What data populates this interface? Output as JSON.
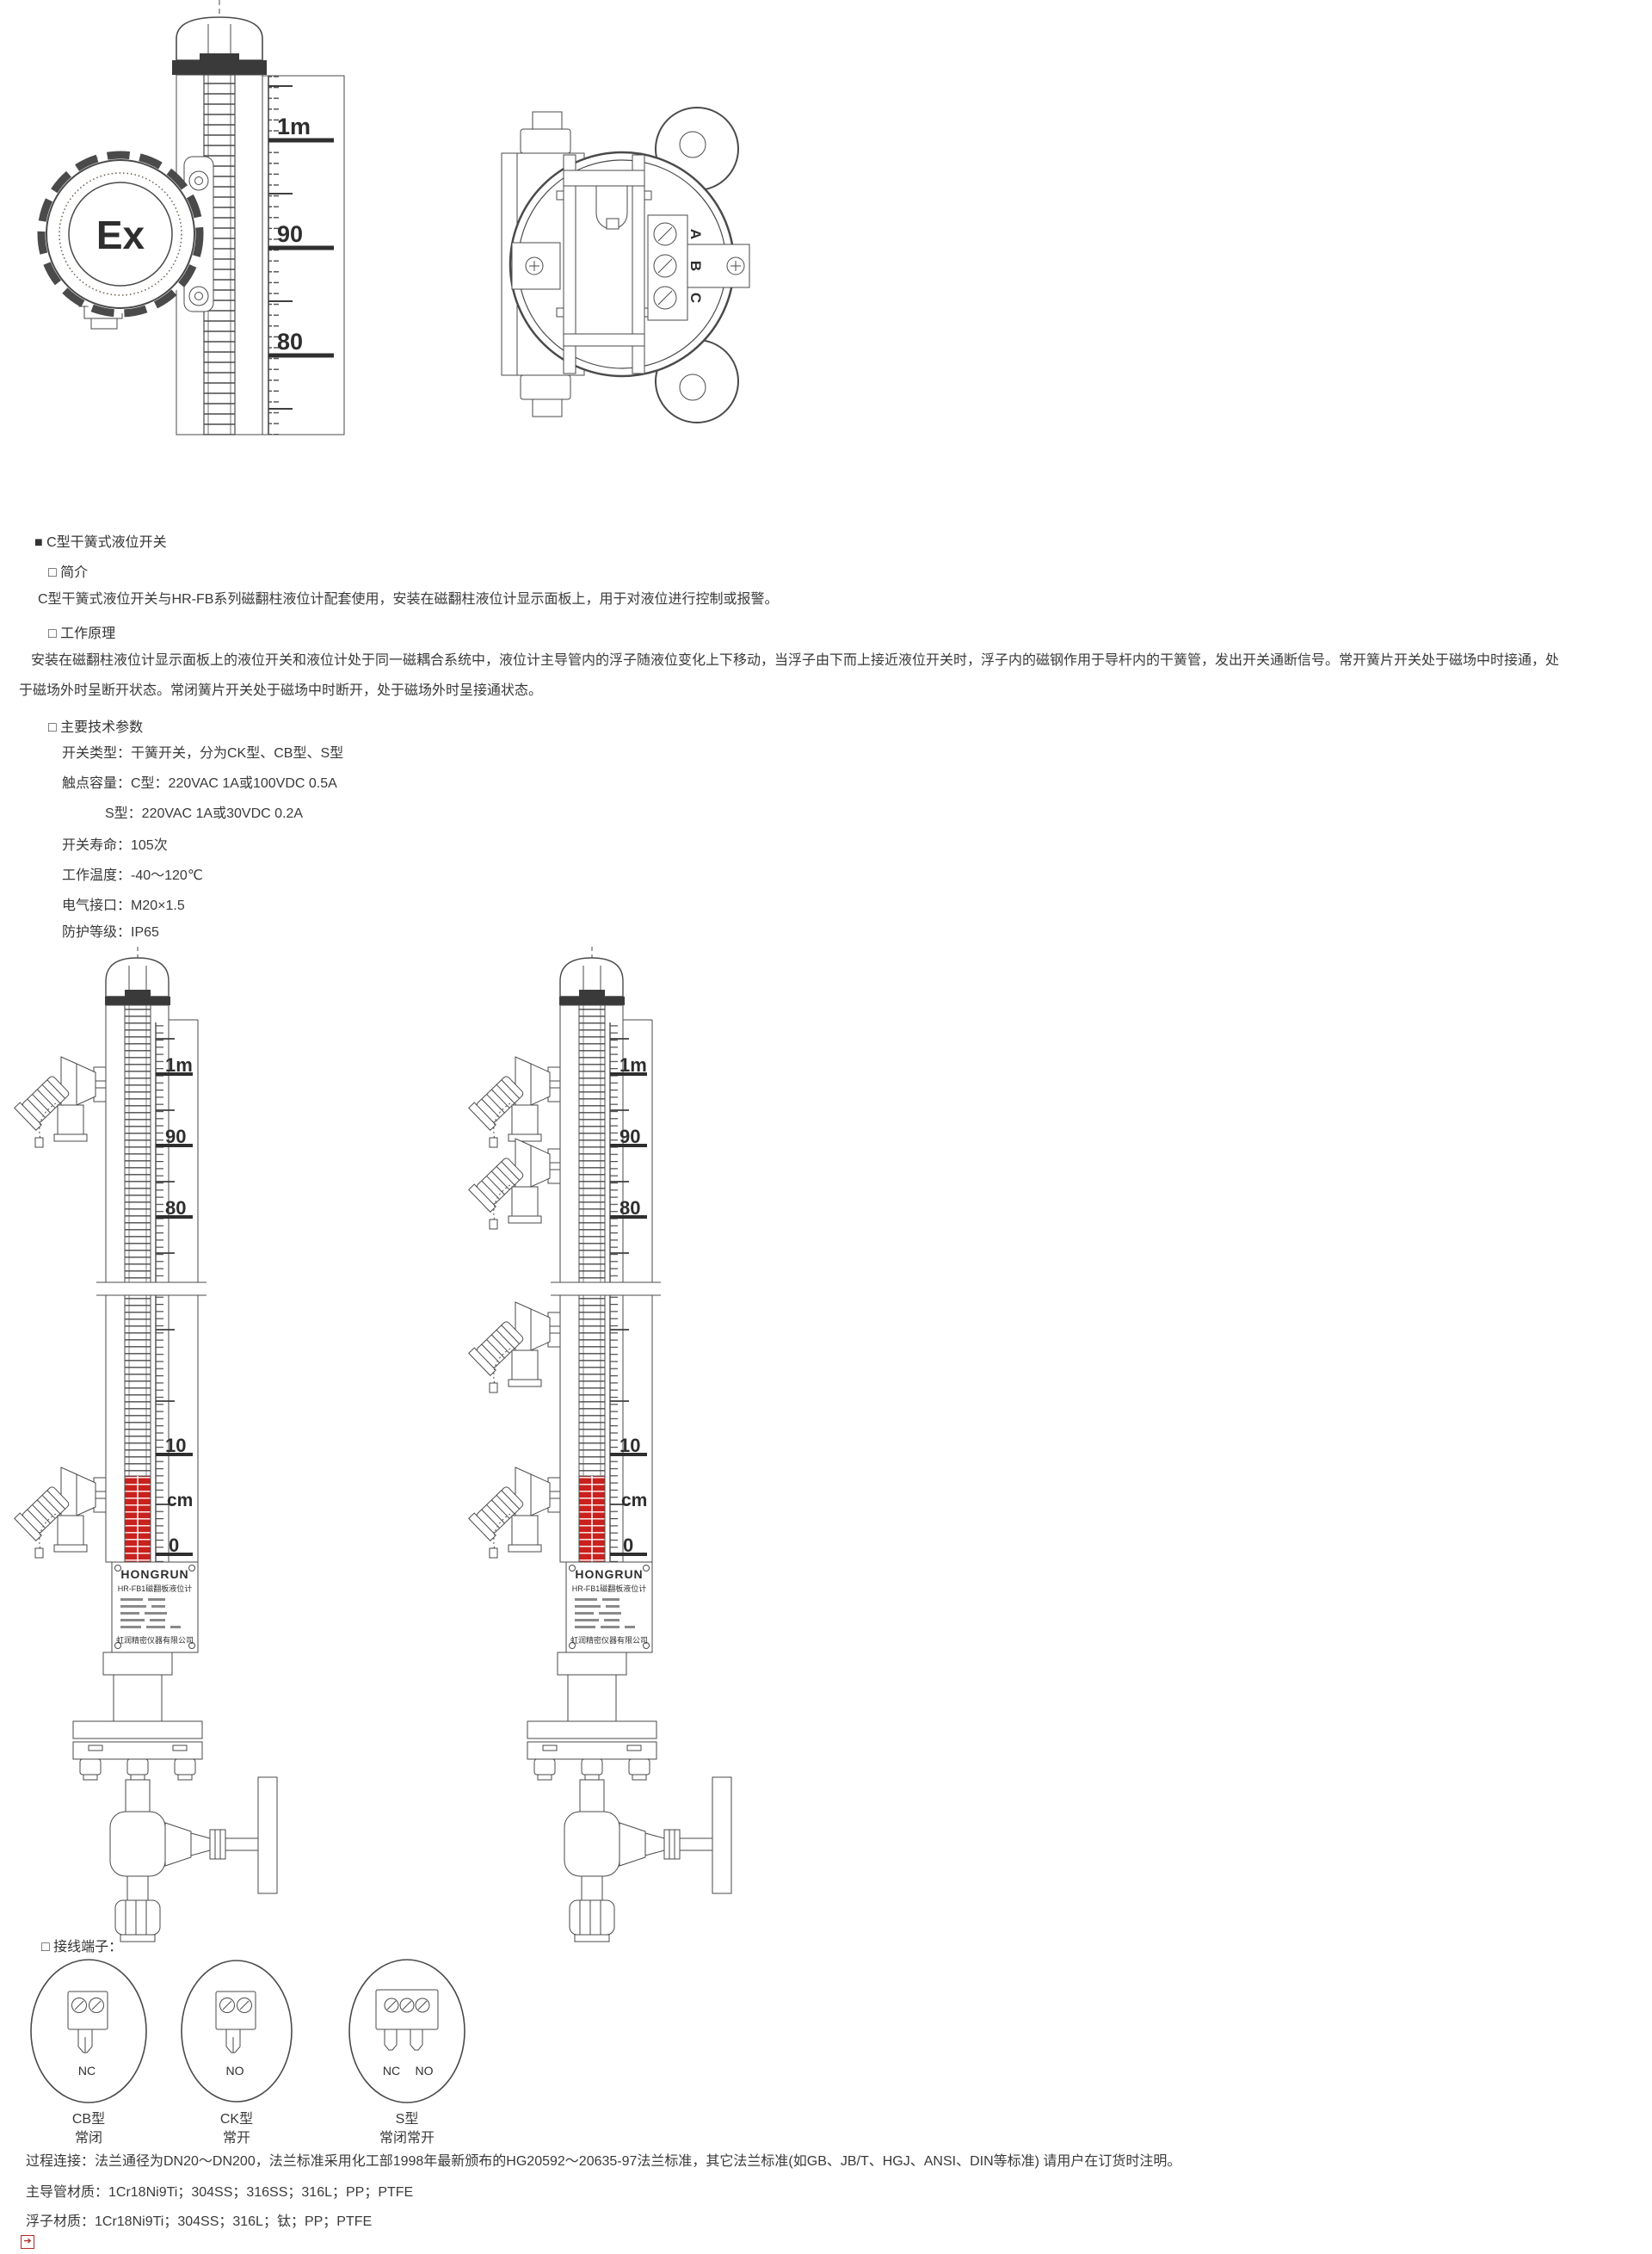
{
  "scale": {
    "m1": "1m",
    "n90": "90",
    "n80": "80",
    "n10": "10",
    "cm": "cm",
    "n0": "0"
  },
  "drawing_top": {
    "ex_mark": "Ex",
    "terminal_a": "A",
    "terminal_b": "B",
    "terminal_c": "C"
  },
  "doc": {
    "title": "■ C型干簧式液位开关",
    "intro_heading": "□ 简介",
    "intro_text": "C型干簧式液位开关与HR-FB系列磁翻柱液位计配套使用，安装在磁翻柱液位计显示面板上，用于对液位进行控制或报警。",
    "principle_heading": "□ 工作原理",
    "principle_line1": "安装在磁翻柱液位计显示面板上的液位开关和液位计处于同一磁耦合系统中，液位计主导管内的浮子随液位变化上下移动，当浮子由下而上接近液位开关时，浮子内的磁钢作用于导杆内的干簧管，发出开关通断信号。常开簧片开关处于磁场中时接通，处",
    "principle_line2": "于磁场外时呈断开状态。常闭簧片开关处于磁场中时断开，处于磁场外时呈接通状态。",
    "params_heading": "□ 主要技术参数",
    "params": [
      "开关类型：干簧开关，分为CK型、CB型、S型",
      "触点容量：C型：220VAC 1A或100VDC 0.5A",
      "S型：220VAC 1A或30VDC 0.2A",
      "开关寿命：105次",
      "工作温度：-40～120℃",
      "电气接口：M20×1.5",
      "防护等级：IP65"
    ]
  },
  "gauge": {
    "brand": "HONGRUN",
    "model": "HR-FB1磁翻板液位计",
    "company": "虹润精密仪器有限公司"
  },
  "terminals": {
    "heading": "□ 接线端子：",
    "cb": {
      "label": "NC",
      "type": "CB型",
      "mode": "常闭"
    },
    "ck": {
      "label": "NO",
      "type": "CK型",
      "mode": "常开"
    },
    "s": {
      "label_left": "NC",
      "label_right": "NO",
      "type": "S型",
      "mode": "常闭常开"
    }
  },
  "footer": {
    "process_line": "过程连接：法兰通径为DN20～DN200，法兰标准采用化工部1998年最新颁布的HG20592～20635-97法兰标准，其它法兰标准(如GB、JB/T、HGJ、ANSI、DIN等标准) 请用户在订货时注明。",
    "tube_line": "主导管材质：1Cr18Ni9Ti；304SS；316SS；316L；PP；PTFE",
    "float_line": "浮子材质：1Cr18Ni9Ti；304SS；316L；钛；PP；PTFE"
  }
}
